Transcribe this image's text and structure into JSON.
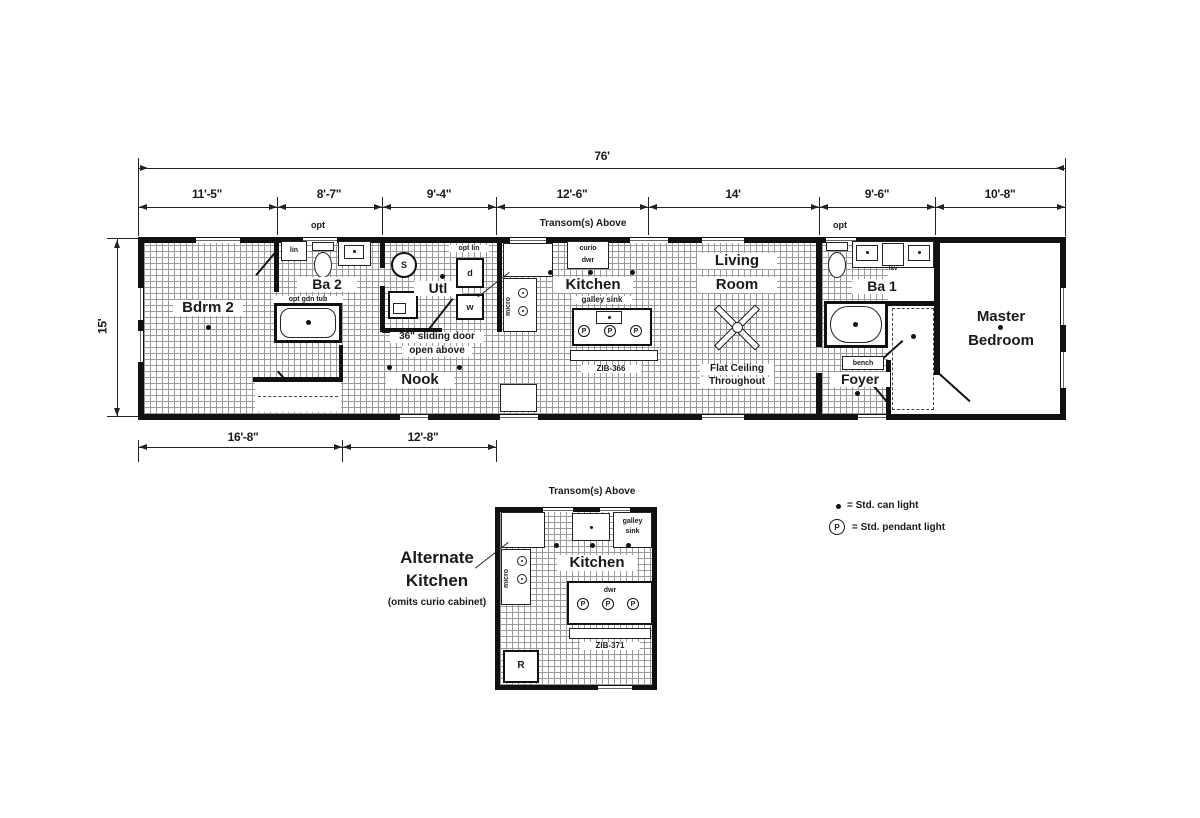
{
  "dims": {
    "overall_width": "76'",
    "overall_height": "15'",
    "top": [
      "11'-5\"",
      "8'-7\"",
      "9'-4\"",
      "12'-6\"",
      "14'",
      "9'-6\"",
      "10'-8\""
    ],
    "bottom": [
      "16'-8\"",
      "12'-8\""
    ]
  },
  "notes": {
    "transom": "Transom(s) Above",
    "opt": "opt"
  },
  "rooms": {
    "bdrm2": "Bdrm 2",
    "ba2": "Ba 2",
    "util": "Utl",
    "nook": "Nook",
    "kitchen": "Kitchen",
    "living_1": "Living",
    "living_2": "Room",
    "ba1": "Ba 1",
    "foyer": "Foyer",
    "master_1": "Master",
    "master_2": "Bedroom"
  },
  "annot": {
    "lin": "lin",
    "opt_lin": "opt lin",
    "opt_gdn_tub": "opt gdn tub",
    "sliding_1": "36\" sliding door",
    "sliding_2": "open above",
    "curio": "curio",
    "dwr": "dwr",
    "micro": "micro",
    "galley_sink": "galley sink",
    "flat_1": "Flat Ceiling",
    "flat_2": "Throughout",
    "bench": "bench",
    "lav": "lav",
    "washer": "w",
    "dryer": "d",
    "water_heater": "S",
    "model": "ZIB-366"
  },
  "alt": {
    "title_1": "Alternate",
    "title_2": "Kitchen",
    "subtitle": "(omits curio cabinet)",
    "transom": "Transom(s) Above",
    "kitchen": "Kitchen",
    "galley_1": "galley",
    "galley_2": "sink",
    "dwr": "dwr",
    "micro": "micro",
    "model": "ZIB-371",
    "fridge": "R"
  },
  "legend": {
    "pendant_symbol": "P",
    "can_label": "= Std. can light",
    "pendant_label": "= Std. pendant light"
  }
}
